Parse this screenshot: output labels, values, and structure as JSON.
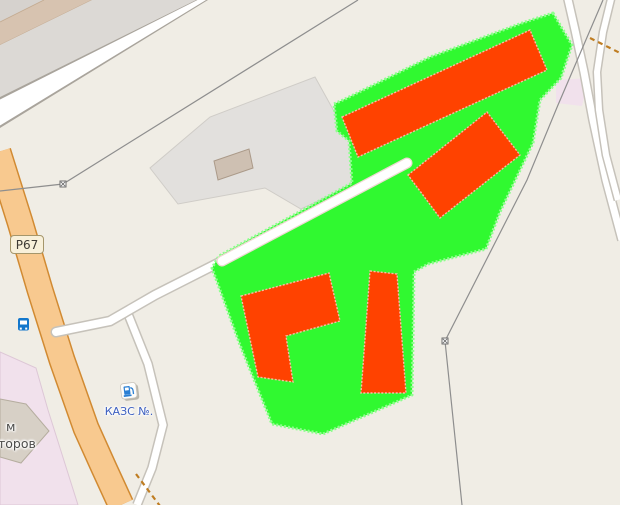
{
  "map": {
    "description": "OSM-style map tile with bright-green selection overlay and red highlighted buildings",
    "background_color": "#f0ede5",
    "labels": {
      "road_ref": "Р67",
      "fuel_station": "КАЗС №.",
      "building_partial_line1": "м",
      "building_partial_line2": "торов"
    },
    "icons": [
      {
        "name": "bus-stop-icon",
        "color": "#1377cc"
      },
      {
        "name": "fuel-station-icon",
        "color": "#2a7fd4"
      },
      {
        "name": "power-pole-icon",
        "color": "#6f6f6f"
      }
    ],
    "overlay": {
      "selected_area_color": "#30f930",
      "selected_building_color": "#ff4200",
      "selected_buildings_count": 4
    },
    "palette": {
      "trunk_road_fill": "#f8c98f",
      "trunk_road_casing": "#d18a32",
      "minor_road_fill": "#ffffff",
      "minor_road_casing": "#c6c2ba",
      "industrial_area": "#e2e0dd",
      "retail_area_pink": "#f1e1ec",
      "railway_band_tan": "#d7c3b0",
      "grey_band": "#dcd9d5",
      "power_line": "#8e8e8e",
      "dashed_path": "#bf7d22",
      "fuel_label_color": "#3c5fc0",
      "building_label_color": "#4c4c4a",
      "badge_fill": "#f8f0da",
      "badge_border": "#a5966b"
    }
  }
}
